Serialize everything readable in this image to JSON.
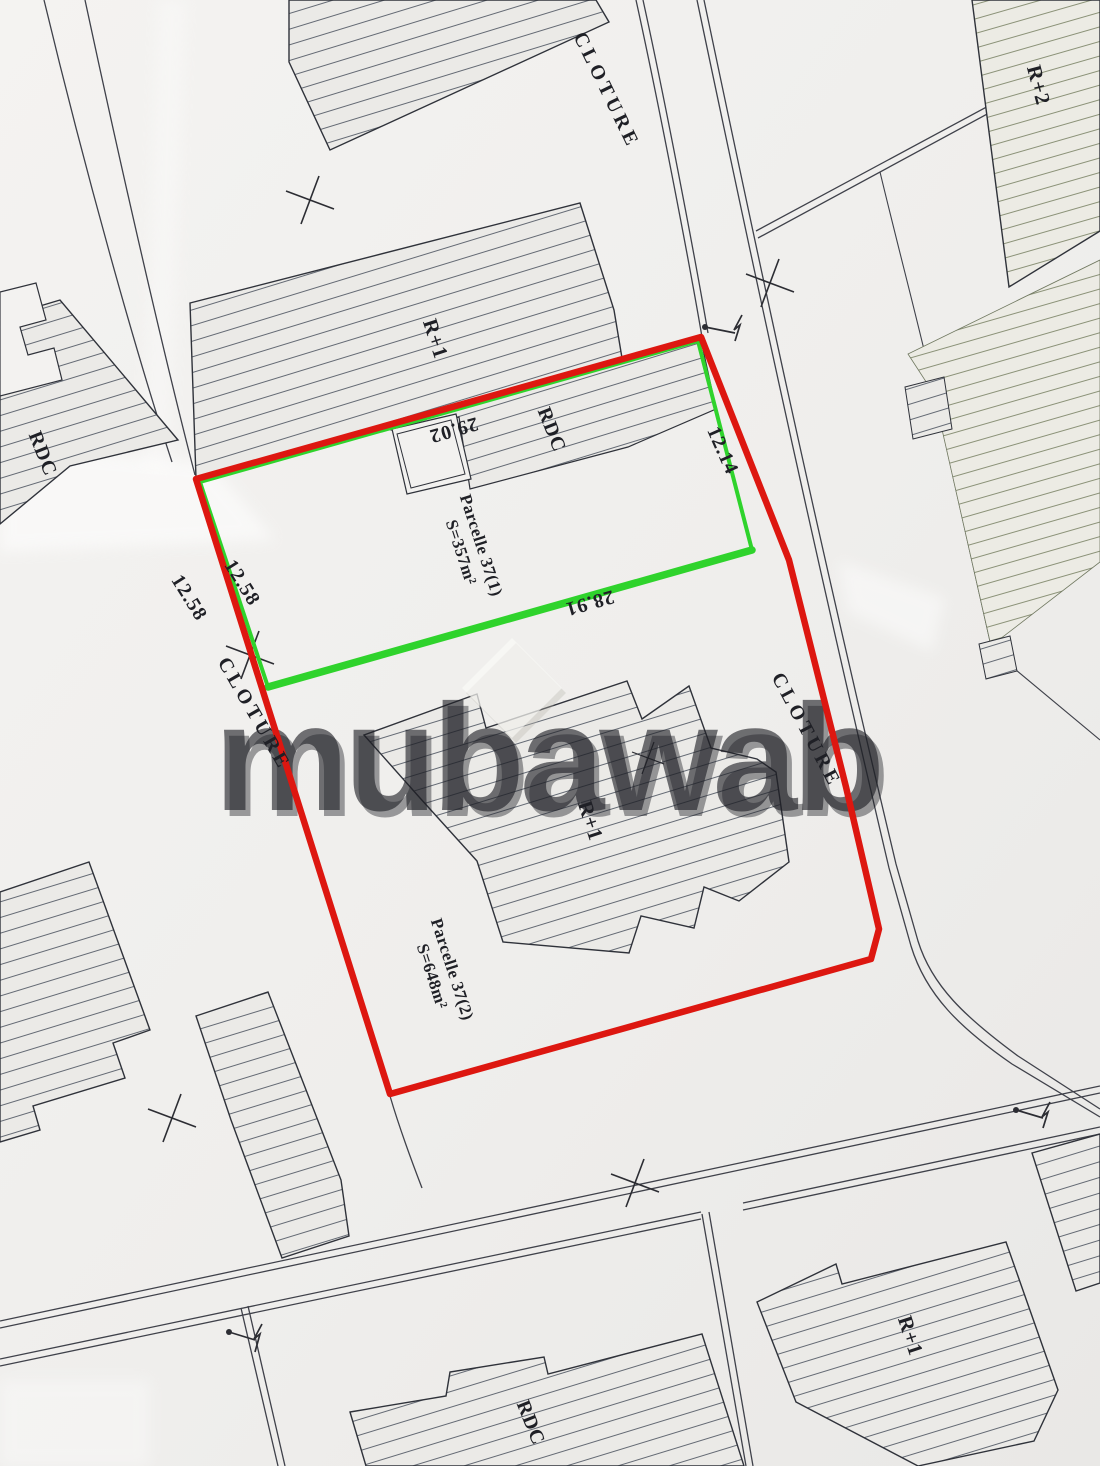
{
  "watermark": {
    "text": "mubawab"
  },
  "roads": {
    "cloture_top": "CLOTURE",
    "cloture_left": "CLOTURE",
    "cloture_right": "CLOTURE"
  },
  "buildings": {
    "r2_top_right": "R+2",
    "r1_top": "R+1",
    "rdc_top": "RDC",
    "rdc_left": "RDC",
    "r1_parcel": "R+1",
    "r1_bottom_right": "R+1",
    "rdc_bottom": "RDC"
  },
  "parcels": {
    "parcel_1": {
      "name": "Parcelle 37(1)",
      "area": "S=357m²"
    },
    "parcel_2": {
      "name": "Parcelle 37(2)",
      "area": "S=648m²"
    }
  },
  "dimensions": {
    "top_edge": "29.02",
    "right_edge": "12.14",
    "divider": "28.91",
    "left_outer": "12.58",
    "left_edge": "12.58"
  },
  "colors": {
    "parcel_outline": "#dd1710",
    "parcel_divider": "#2fd32c",
    "ink": "#23242b",
    "paper": "#f1f0ee"
  }
}
